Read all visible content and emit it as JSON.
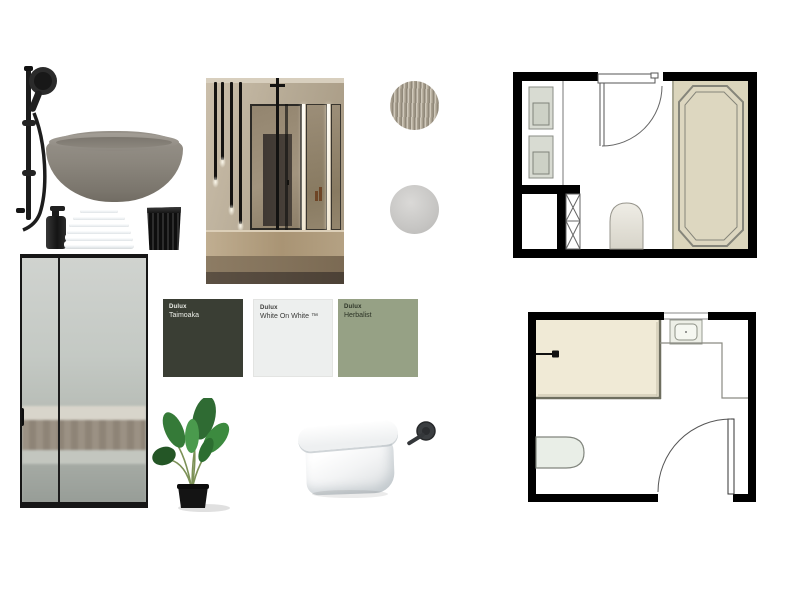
{
  "board": {
    "name": "Bathroom mood board",
    "background": "#ffffff"
  },
  "paint_chips": [
    {
      "brand": "Dulux",
      "name": "Taimoaka",
      "color": "#3a3e34",
      "text_color": "#eceee8"
    },
    {
      "brand": "Dulux",
      "name": "White On White ™",
      "color": "#edefee",
      "text_color": "#3b3b39"
    },
    {
      "brand": "Dulux",
      "name": "Herbalist",
      "color": "#96a185",
      "text_color": "#2c3326"
    }
  ],
  "material_swatches": [
    {
      "name": "fluted-tile-swatch"
    },
    {
      "name": "grey-marble-swatch"
    },
    {
      "name": "concrete-swatch"
    }
  ],
  "products": [
    {
      "name": "black-shower-rail"
    },
    {
      "name": "concrete-freestanding-bathtub",
      "color": "#8b867d"
    },
    {
      "name": "black-soap-dispenser"
    },
    {
      "name": "white-towel-stack"
    },
    {
      "name": "black-ribbed-tumbler"
    },
    {
      "name": "bathroom-interior-photo"
    },
    {
      "name": "black-framed-shower-screen"
    },
    {
      "name": "potted-plant"
    },
    {
      "name": "wall-hung-toilet"
    },
    {
      "name": "black-wall-mixer-tap"
    }
  ],
  "floor_plans": [
    {
      "name": "bathroom-plan-with-corner-bath",
      "room_fill": "#dbd5bc"
    },
    {
      "name": "bathroom-plan-with-shower-area",
      "room_fill": "#f0ead6"
    }
  ]
}
